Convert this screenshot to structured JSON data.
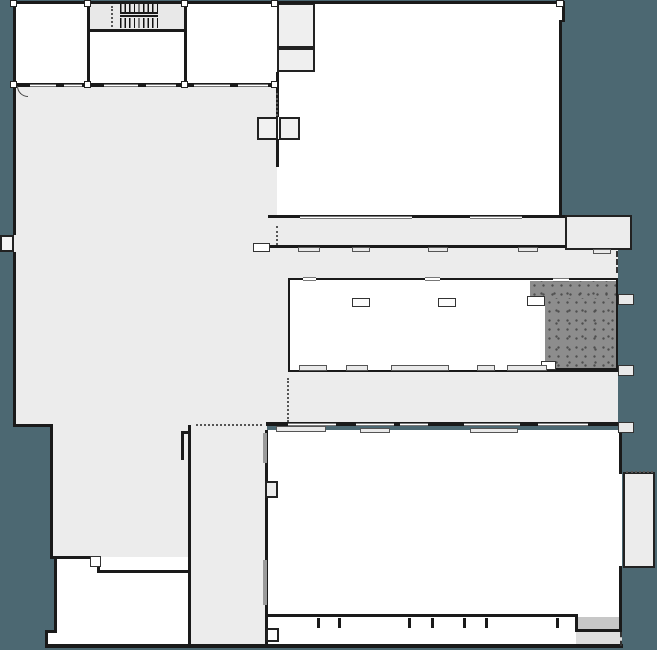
{
  "meta": {
    "title": "Architectural floor plan",
    "description": "Building ground-floor plan on teal background: light-gray hall and corridors, white rooms, stair core, elevator shafts, stippled dark room at mid-right, window openings and sills along facade walls."
  },
  "colors": {
    "background": "#4c6872",
    "building_gray": "#ececec",
    "room_white": "#ffffff",
    "wall_dark": "#1a1a1a",
    "stipple_base": "#8d8d8d",
    "stipple_dot": "#4f4f4f",
    "sill_gray": "#e9e9e9",
    "thick_gray_wall": "#9a9a9a"
  },
  "regions": [
    {
      "name": "large-hall",
      "role": "open hall, left half"
    },
    {
      "name": "stair-core",
      "role": "staircase, top-left"
    },
    {
      "name": "elevator-shafts",
      "role": "double shaft on central wall"
    },
    {
      "name": "upper-right-room",
      "role": "large white room, top-right"
    },
    {
      "name": "corridor-bands",
      "role": "horizontal circulation bands, mid-right"
    },
    {
      "name": "stippled-room",
      "role": "dark textured room, mid-right"
    },
    {
      "name": "lower-right-room",
      "role": "large white room, bottom-right"
    },
    {
      "name": "vertical-corridor",
      "role": "gray corridor, bottom-center"
    },
    {
      "name": "bottom-left-room",
      "role": "white room, bottom-left"
    }
  ],
  "shapes": [
    {
      "name": "hall-upper-fill",
      "kind": "fill",
      "x": 13,
      "y": 85,
      "w": 264,
      "h": 340,
      "fill": "#ececec"
    },
    {
      "name": "hall-lower-fill",
      "kind": "fill",
      "x": 50,
      "y": 425,
      "w": 140,
      "h": 133,
      "fill": "#ececec"
    },
    {
      "name": "hall-step-fill",
      "kind": "fill",
      "x": 100,
      "y": 557,
      "w": 90,
      "h": 16,
      "fill": "#ececec"
    },
    {
      "name": "vertical-corridor-fill",
      "kind": "fill",
      "x": 190,
      "y": 425,
      "w": 77,
      "h": 223,
      "fill": "#ececec"
    },
    {
      "name": "band-d-fill",
      "kind": "fill",
      "x": 268,
      "y": 218,
      "w": 297,
      "h": 30,
      "fill": "#ececec"
    },
    {
      "name": "band-e-fill",
      "kind": "fill",
      "x": 268,
      "y": 248,
      "w": 350,
      "h": 30,
      "fill": "#ececec"
    },
    {
      "name": "band-g-fill",
      "kind": "fill",
      "x": 268,
      "y": 372,
      "w": 350,
      "h": 53,
      "fill": "#ececec"
    },
    {
      "name": "strip-ef-fill",
      "kind": "fill",
      "x": 268,
      "y": 278,
      "w": 22,
      "h": 94,
      "fill": "#ececec"
    },
    {
      "name": "room-a-fill",
      "kind": "fill",
      "x": 13,
      "y": 3,
      "w": 264,
      "h": 82,
      "fill": "#ffffff"
    },
    {
      "name": "stair-fill",
      "kind": "fill",
      "x": 88,
      "y": 3,
      "w": 97,
      "h": 27,
      "fill": "#e8e8e8"
    },
    {
      "name": "room-c-fill",
      "kind": "fill",
      "x": 277,
      "y": 3,
      "w": 285,
      "h": 215,
      "fill": "#ffffff"
    },
    {
      "name": "room-b1",
      "kind": "room",
      "x": 277,
      "y": 3,
      "w": 38,
      "h": 45,
      "fill": "#efefef",
      "border": "2px solid #222"
    },
    {
      "name": "room-b2",
      "kind": "room",
      "x": 277,
      "y": 48,
      "w": 38,
      "h": 24,
      "fill": "#efefef",
      "border": "2px solid #222"
    },
    {
      "name": "d2-room",
      "kind": "room",
      "x": 565,
      "y": 215,
      "w": 67,
      "h": 35,
      "fill": "#ececec",
      "border": "2.5px solid #222"
    },
    {
      "name": "room-f",
      "kind": "room",
      "x": 288,
      "y": 278,
      "w": 330,
      "h": 94,
      "fill": "#ffffff",
      "border": "2.5px solid #1a1a1a"
    },
    {
      "name": "stipple-top",
      "kind": "stipple",
      "x": 530,
      "y": 281,
      "w": 86,
      "h": 19
    },
    {
      "name": "stipple-main",
      "kind": "stipple",
      "x": 545,
      "y": 298,
      "w": 71,
      "h": 71
    },
    {
      "name": "room-k-fill",
      "kind": "fill",
      "x": 267,
      "y": 430,
      "w": 355,
      "h": 187,
      "fill": "#ffffff"
    },
    {
      "name": "bumpout-room",
      "kind": "room",
      "x": 623,
      "y": 472,
      "w": 32,
      "h": 96,
      "fill": "#ececec",
      "border": "2.5px solid #222"
    },
    {
      "name": "bumpout-top-dotted",
      "kind": "dotted-h",
      "x": 626,
      "y": 471,
      "w": 27,
      "h": 0
    },
    {
      "name": "room-bl-fill",
      "kind": "fill",
      "x": 54,
      "y": 557,
      "w": 134,
      "h": 89,
      "fill": "#ffffff"
    },
    {
      "name": "room-bl-ext",
      "kind": "fill",
      "x": 45,
      "y": 630,
      "w": 12,
      "h": 16,
      "fill": "#ffffff"
    },
    {
      "name": "k-bottom-strip",
      "kind": "fill",
      "x": 267,
      "y": 617,
      "w": 355,
      "h": 28,
      "fill": "#ffffff"
    },
    {
      "name": "recess-fill",
      "kind": "fill",
      "x": 578,
      "y": 617,
      "w": 41,
      "h": 13,
      "fill": "#c7c7c7"
    },
    {
      "name": "br-gray-strip",
      "kind": "fill",
      "x": 576,
      "y": 632,
      "w": 46,
      "h": 14,
      "fill": "#dedede"
    },
    {
      "name": "left-tab",
      "kind": "room",
      "x": 0,
      "y": 235,
      "w": 14,
      "h": 17,
      "fill": "#f4f4f4",
      "border": "2px solid #222"
    },
    {
      "name": "wall-top",
      "kind": "wall",
      "x": 13,
      "y": 1,
      "w": 549,
      "h": 3
    },
    {
      "name": "wall-top-jog",
      "kind": "wall",
      "x": 562,
      "y": 1,
      "w": 3,
      "h": 21
    },
    {
      "name": "wall-c-right",
      "kind": "wall",
      "x": 559,
      "y": 20,
      "w": 3,
      "h": 198
    },
    {
      "name": "wall-left-upper",
      "kind": "wall",
      "x": 13,
      "y": 1,
      "w": 3,
      "h": 234
    },
    {
      "name": "wall-left-mid",
      "kind": "wall",
      "x": 13,
      "y": 252,
      "w": 3,
      "h": 174
    },
    {
      "name": "wall-step-h",
      "kind": "wall",
      "x": 13,
      "y": 424,
      "w": 39,
      "h": 3
    },
    {
      "name": "wall-left-lower",
      "kind": "wall",
      "x": 50,
      "y": 424,
      "w": 3,
      "h": 135
    },
    {
      "name": "wall-hall-bottom",
      "kind": "wall",
      "x": 50,
      "y": 556,
      "w": 50,
      "h": 3
    },
    {
      "name": "wall-bl-step-v",
      "kind": "wall",
      "x": 97,
      "y": 557,
      "w": 3,
      "h": 16
    },
    {
      "name": "wall-bl-step-h",
      "kind": "wall",
      "x": 97,
      "y": 570,
      "w": 93,
      "h": 3
    },
    {
      "name": "wall-bl-left",
      "kind": "wall",
      "x": 54,
      "y": 557,
      "w": 3,
      "h": 76
    },
    {
      "name": "wall-bl-jog-h",
      "kind": "wall",
      "x": 45,
      "y": 630,
      "w": 12,
      "h": 3
    },
    {
      "name": "wall-bl-jog-v",
      "kind": "wall",
      "x": 45,
      "y": 630,
      "w": 3,
      "h": 18
    },
    {
      "name": "wall-bottom-main",
      "kind": "wall",
      "x": 45,
      "y": 644,
      "w": 578,
      "h": 4
    },
    {
      "name": "wall-corrv-left",
      "kind": "wall",
      "x": 188,
      "y": 425,
      "w": 3,
      "h": 221
    },
    {
      "name": "wall-corrv-right",
      "kind": "wall",
      "x": 265,
      "y": 430,
      "w": 3,
      "h": 216
    },
    {
      "name": "wall-a-bottom",
      "kind": "wall",
      "x": 13,
      "y": 83,
      "w": 264,
      "h": 3.5
    },
    {
      "name": "wall-a-v1",
      "kind": "wall",
      "x": 87,
      "y": 3,
      "w": 2.5,
      "h": 80
    },
    {
      "name": "wall-a-v2",
      "kind": "wall",
      "x": 184,
      "y": 3,
      "w": 2.5,
      "h": 80
    },
    {
      "name": "wall-stair-bottom",
      "kind": "wall",
      "x": 88,
      "y": 29,
      "w": 98,
      "h": 2.5
    },
    {
      "name": "wall-b-below",
      "kind": "wall",
      "x": 276,
      "y": 72,
      "w": 3,
      "h": 14
    },
    {
      "name": "wall-c-left-1",
      "kind": "wall",
      "x": 276,
      "y": 85,
      "w": 3,
      "h": 32
    },
    {
      "name": "wall-c-left-2",
      "kind": "wall",
      "x": 276,
      "y": 139,
      "w": 3,
      "h": 28
    },
    {
      "name": "wall-band-d-top",
      "kind": "wall",
      "x": 268,
      "y": 215,
      "w": 297,
      "h": 3
    },
    {
      "name": "wall-band-d-bottom",
      "kind": "wall",
      "x": 268,
      "y": 245,
      "w": 298,
      "h": 2.5
    },
    {
      "name": "wall-band-g-bottom",
      "kind": "wall",
      "x": 266,
      "y": 422,
      "w": 352,
      "h": 3.5
    },
    {
      "name": "wall-f-bottom-dark",
      "kind": "wall",
      "x": 530,
      "y": 368,
      "w": 88,
      "h": 4
    },
    {
      "name": "wall-k-right-top",
      "kind": "wall",
      "x": 619,
      "y": 432,
      "w": 3,
      "h": 42
    },
    {
      "name": "wall-k-right-bot",
      "kind": "wall",
      "x": 619,
      "y": 566,
      "w": 3,
      "h": 51
    },
    {
      "name": "wall-k-bottom",
      "kind": "wall",
      "x": 266,
      "y": 614,
      "w": 311,
      "h": 3
    },
    {
      "name": "wall-recess-left",
      "kind": "wall",
      "x": 575,
      "y": 614,
      "w": 3,
      "h": 18
    },
    {
      "name": "wall-recess-h",
      "kind": "wall",
      "x": 575,
      "y": 629,
      "w": 47,
      "h": 3
    },
    {
      "name": "wall-recess-right",
      "kind": "wall",
      "x": 619,
      "y": 617,
      "w": 3,
      "h": 15
    },
    {
      "name": "mullion-1",
      "kind": "wall",
      "x": 317,
      "y": 618,
      "w": 2.5,
      "h": 10
    },
    {
      "name": "mullion-2",
      "kind": "wall",
      "x": 338,
      "y": 618,
      "w": 2.5,
      "h": 10
    },
    {
      "name": "mullion-3",
      "kind": "wall",
      "x": 408,
      "y": 618,
      "w": 2.5,
      "h": 10
    },
    {
      "name": "mullion-4",
      "kind": "wall",
      "x": 431,
      "y": 618,
      "w": 2.5,
      "h": 10
    },
    {
      "name": "mullion-5",
      "kind": "wall",
      "x": 463,
      "y": 618,
      "w": 2.5,
      "h": 10
    },
    {
      "name": "mullion-6",
      "kind": "wall",
      "x": 485,
      "y": 618,
      "w": 2.5,
      "h": 10
    },
    {
      "name": "mullion-7",
      "kind": "wall",
      "x": 556,
      "y": 618,
      "w": 2.5,
      "h": 10
    },
    {
      "name": "k-bottom-box",
      "kind": "room",
      "x": 266,
      "y": 628,
      "w": 13,
      "h": 14,
      "fill": "#ffffff",
      "border": "2px solid #222"
    },
    {
      "name": "win-a1",
      "kind": "window",
      "x": 30,
      "y": 83.5,
      "w": 26,
      "h": 3.5
    },
    {
      "name": "win-a2",
      "kind": "window",
      "x": 64,
      "y": 83.5,
      "w": 18,
      "h": 3.5
    },
    {
      "name": "win-a3",
      "kind": "window",
      "x": 104,
      "y": 83.5,
      "w": 34,
      "h": 3.5
    },
    {
      "name": "win-a4",
      "kind": "window",
      "x": 146,
      "y": 83.5,
      "w": 30,
      "h": 3.5
    },
    {
      "name": "win-a5",
      "kind": "window",
      "x": 194,
      "y": 83.5,
      "w": 36,
      "h": 3.5
    },
    {
      "name": "win-a6",
      "kind": "window",
      "x": 238,
      "y": 83.5,
      "w": 30,
      "h": 3.5
    },
    {
      "name": "door-arc",
      "kind": "arc",
      "x": 17,
      "y": 86,
      "w": 11,
      "h": 11
    },
    {
      "name": "win-d-top1",
      "kind": "window",
      "x": 300,
      "y": 215.5,
      "w": 112,
      "h": 3.5
    },
    {
      "name": "win-d-top2",
      "kind": "window",
      "x": 470,
      "y": 215.5,
      "w": 52,
      "h": 3.5
    },
    {
      "name": "stub-d-left",
      "kind": "room",
      "x": 253,
      "y": 243,
      "w": 17,
      "h": 9,
      "fill": "#ffffff",
      "border": "1.5px solid #333"
    },
    {
      "name": "sill-d1",
      "kind": "sill",
      "x": 298,
      "y": 247,
      "w": 22,
      "h": 5
    },
    {
      "name": "sill-d2",
      "kind": "sill",
      "x": 352,
      "y": 247,
      "w": 18,
      "h": 5
    },
    {
      "name": "sill-d3",
      "kind": "sill",
      "x": 428,
      "y": 247,
      "w": 20,
      "h": 5
    },
    {
      "name": "sill-d4",
      "kind": "sill",
      "x": 518,
      "y": 247,
      "w": 20,
      "h": 5
    },
    {
      "name": "sill-d5",
      "kind": "sill",
      "x": 593,
      "y": 249,
      "w": 18,
      "h": 5
    },
    {
      "name": "dashed-e-right",
      "kind": "dashed-v",
      "x": 616,
      "y": 251,
      "w": 0,
      "h": 22
    },
    {
      "name": "f-col1",
      "kind": "room",
      "x": 352,
      "y": 298,
      "w": 18,
      "h": 9,
      "fill": "#fcfcfc",
      "border": "1.5px solid #333"
    },
    {
      "name": "f-col2",
      "kind": "room",
      "x": 438,
      "y": 298,
      "w": 18,
      "h": 9,
      "fill": "#fcfcfc",
      "border": "1.5px solid #333"
    },
    {
      "name": "f-open-top1",
      "kind": "window",
      "x": 303,
      "y": 277,
      "w": 13,
      "h": 4
    },
    {
      "name": "f-open-top2",
      "kind": "window",
      "x": 425,
      "y": 277,
      "w": 15,
      "h": 4
    },
    {
      "name": "f-open-top3",
      "kind": "window",
      "x": 553,
      "y": 278,
      "w": 16,
      "h": 4
    },
    {
      "name": "stipple-open-left",
      "kind": "room",
      "x": 527,
      "y": 296,
      "w": 18,
      "h": 10,
      "fill": "#ffffff",
      "border": "1.5px solid #333"
    },
    {
      "name": "stipple-open-bottom",
      "kind": "room",
      "x": 541,
      "y": 361,
      "w": 15,
      "h": 9,
      "fill": "#ffffff",
      "border": "1.5px solid #333"
    },
    {
      "name": "sill-f1",
      "kind": "sill",
      "x": 299,
      "y": 365,
      "w": 28,
      "h": 6
    },
    {
      "name": "sill-f2",
      "kind": "sill",
      "x": 346,
      "y": 365,
      "w": 22,
      "h": 6
    },
    {
      "name": "sill-f3",
      "kind": "sill",
      "x": 391,
      "y": 365,
      "w": 58,
      "h": 6
    },
    {
      "name": "sill-f4",
      "kind": "sill",
      "x": 477,
      "y": 365,
      "w": 18,
      "h": 6
    },
    {
      "name": "sill-f5",
      "kind": "sill",
      "x": 507,
      "y": 365,
      "w": 40,
      "h": 6
    },
    {
      "name": "win-g1",
      "kind": "window",
      "x": 288,
      "y": 422.5,
      "w": 48,
      "h": 3.5
    },
    {
      "name": "win-g2",
      "kind": "window",
      "x": 356,
      "y": 422.5,
      "w": 38,
      "h": 3.5
    },
    {
      "name": "win-g3",
      "kind": "window",
      "x": 400,
      "y": 422.5,
      "w": 28,
      "h": 3.5
    },
    {
      "name": "win-g4",
      "kind": "window",
      "x": 464,
      "y": 422.5,
      "w": 56,
      "h": 3.5
    },
    {
      "name": "win-g5",
      "kind": "window",
      "x": 538,
      "y": 422.5,
      "w": 50,
      "h": 3.5
    },
    {
      "name": "sill-g1",
      "kind": "sill",
      "x": 276,
      "y": 426,
      "w": 50,
      "h": 6
    },
    {
      "name": "sill-g2",
      "kind": "sill",
      "x": 360,
      "y": 428,
      "w": 30,
      "h": 5
    },
    {
      "name": "sill-g3",
      "kind": "sill",
      "x": 470,
      "y": 428,
      "w": 48,
      "h": 5
    },
    {
      "name": "stub-r1",
      "kind": "stub",
      "x": 618,
      "y": 294,
      "w": 16,
      "h": 11
    },
    {
      "name": "stub-r2",
      "kind": "stub",
      "x": 618,
      "y": 365,
      "w": 16,
      "h": 11
    },
    {
      "name": "stub-r3",
      "kind": "stub",
      "x": 618,
      "y": 422,
      "w": 16,
      "h": 11
    },
    {
      "name": "dotted-stair",
      "kind": "dotted-v",
      "x": 111,
      "y": 6,
      "w": 0,
      "h": 21
    },
    {
      "name": "dotted-elevator",
      "kind": "dotted-v",
      "x": 276,
      "y": 93,
      "w": 0,
      "h": 23
    },
    {
      "name": "dotted-band-d",
      "kind": "dotted-v",
      "x": 276,
      "y": 226,
      "w": 0,
      "h": 19
    },
    {
      "name": "dotted-band-g",
      "kind": "dotted-v",
      "x": 287,
      "y": 378,
      "w": 0,
      "h": 44
    },
    {
      "name": "dotted-corridor-top",
      "kind": "dotted-h",
      "x": 196,
      "y": 424,
      "w": 66,
      "h": 0
    },
    {
      "name": "dashed-bottom-right",
      "kind": "dashed-v",
      "x": 620,
      "y": 632,
      "w": 0,
      "h": 14
    },
    {
      "name": "elevator-shaft-1",
      "kind": "room",
      "x": 257,
      "y": 117,
      "w": 21,
      "h": 23,
      "fill": "#f1f1f1",
      "border": "2.5px solid #222"
    },
    {
      "name": "elevator-shaft-2",
      "kind": "room",
      "x": 279,
      "y": 117,
      "w": 21,
      "h": 23,
      "fill": "#f1f1f1",
      "border": "2.5px solid #222"
    },
    {
      "name": "stair-treads-upper",
      "kind": "treads",
      "x": 120,
      "y": 4,
      "w": 38,
      "h": 8
    },
    {
      "name": "stair-treads-lower",
      "kind": "treads",
      "x": 120,
      "y": 18,
      "w": 38,
      "h": 10
    },
    {
      "name": "stair-landing-bar1",
      "kind": "wall",
      "x": 120,
      "y": 12,
      "w": 38,
      "h": 2
    },
    {
      "name": "stair-landing-bar2",
      "kind": "wall",
      "x": 120,
      "y": 15,
      "w": 38,
      "h": 2
    },
    {
      "name": "column-t1",
      "kind": "colsq",
      "x": 10,
      "y": 0,
      "w": 7,
      "h": 7
    },
    {
      "name": "column-t2",
      "kind": "colsq",
      "x": 84,
      "y": 0,
      "w": 7,
      "h": 7
    },
    {
      "name": "column-t3",
      "kind": "colsq",
      "x": 181,
      "y": 0,
      "w": 7,
      "h": 7
    },
    {
      "name": "column-t4",
      "kind": "colsq",
      "x": 271,
      "y": 0,
      "w": 7,
      "h": 7
    },
    {
      "name": "column-t5",
      "kind": "colsq",
      "x": 556,
      "y": 0,
      "w": 8,
      "h": 7
    },
    {
      "name": "column-m1",
      "kind": "colsq",
      "x": 10,
      "y": 81,
      "w": 7,
      "h": 7
    },
    {
      "name": "column-m2",
      "kind": "colsq",
      "x": 84,
      "y": 81,
      "w": 7,
      "h": 7
    },
    {
      "name": "column-m3",
      "kind": "colsq",
      "x": 181,
      "y": 81,
      "w": 7,
      "h": 7
    },
    {
      "name": "column-m4",
      "kind": "colsq",
      "x": 271,
      "y": 81,
      "w": 7,
      "h": 7
    },
    {
      "name": "corrv-gray1",
      "kind": "fill",
      "x": 263,
      "y": 433,
      "w": 4,
      "h": 30,
      "fill": "#9a9a9a"
    },
    {
      "name": "corrv-gray2",
      "kind": "fill",
      "x": 263,
      "y": 560,
      "w": 4,
      "h": 45,
      "fill": "#9a9a9a"
    },
    {
      "name": "corrv-notch",
      "kind": "room",
      "x": 265,
      "y": 481,
      "w": 13,
      "h": 17,
      "fill": "#ececec",
      "border": "2px solid #222"
    },
    {
      "name": "corrv-tick-h",
      "kind": "wall",
      "x": 181,
      "y": 431,
      "w": 8,
      "h": 2.5
    },
    {
      "name": "corrv-tick-v",
      "kind": "wall",
      "x": 181,
      "y": 431,
      "w": 2.5,
      "h": 29
    },
    {
      "name": "bl-door-square",
      "kind": "room",
      "x": 90,
      "y": 556,
      "w": 11,
      "h": 11,
      "fill": "#ffffff",
      "border": "1.5px solid #333"
    }
  ]
}
